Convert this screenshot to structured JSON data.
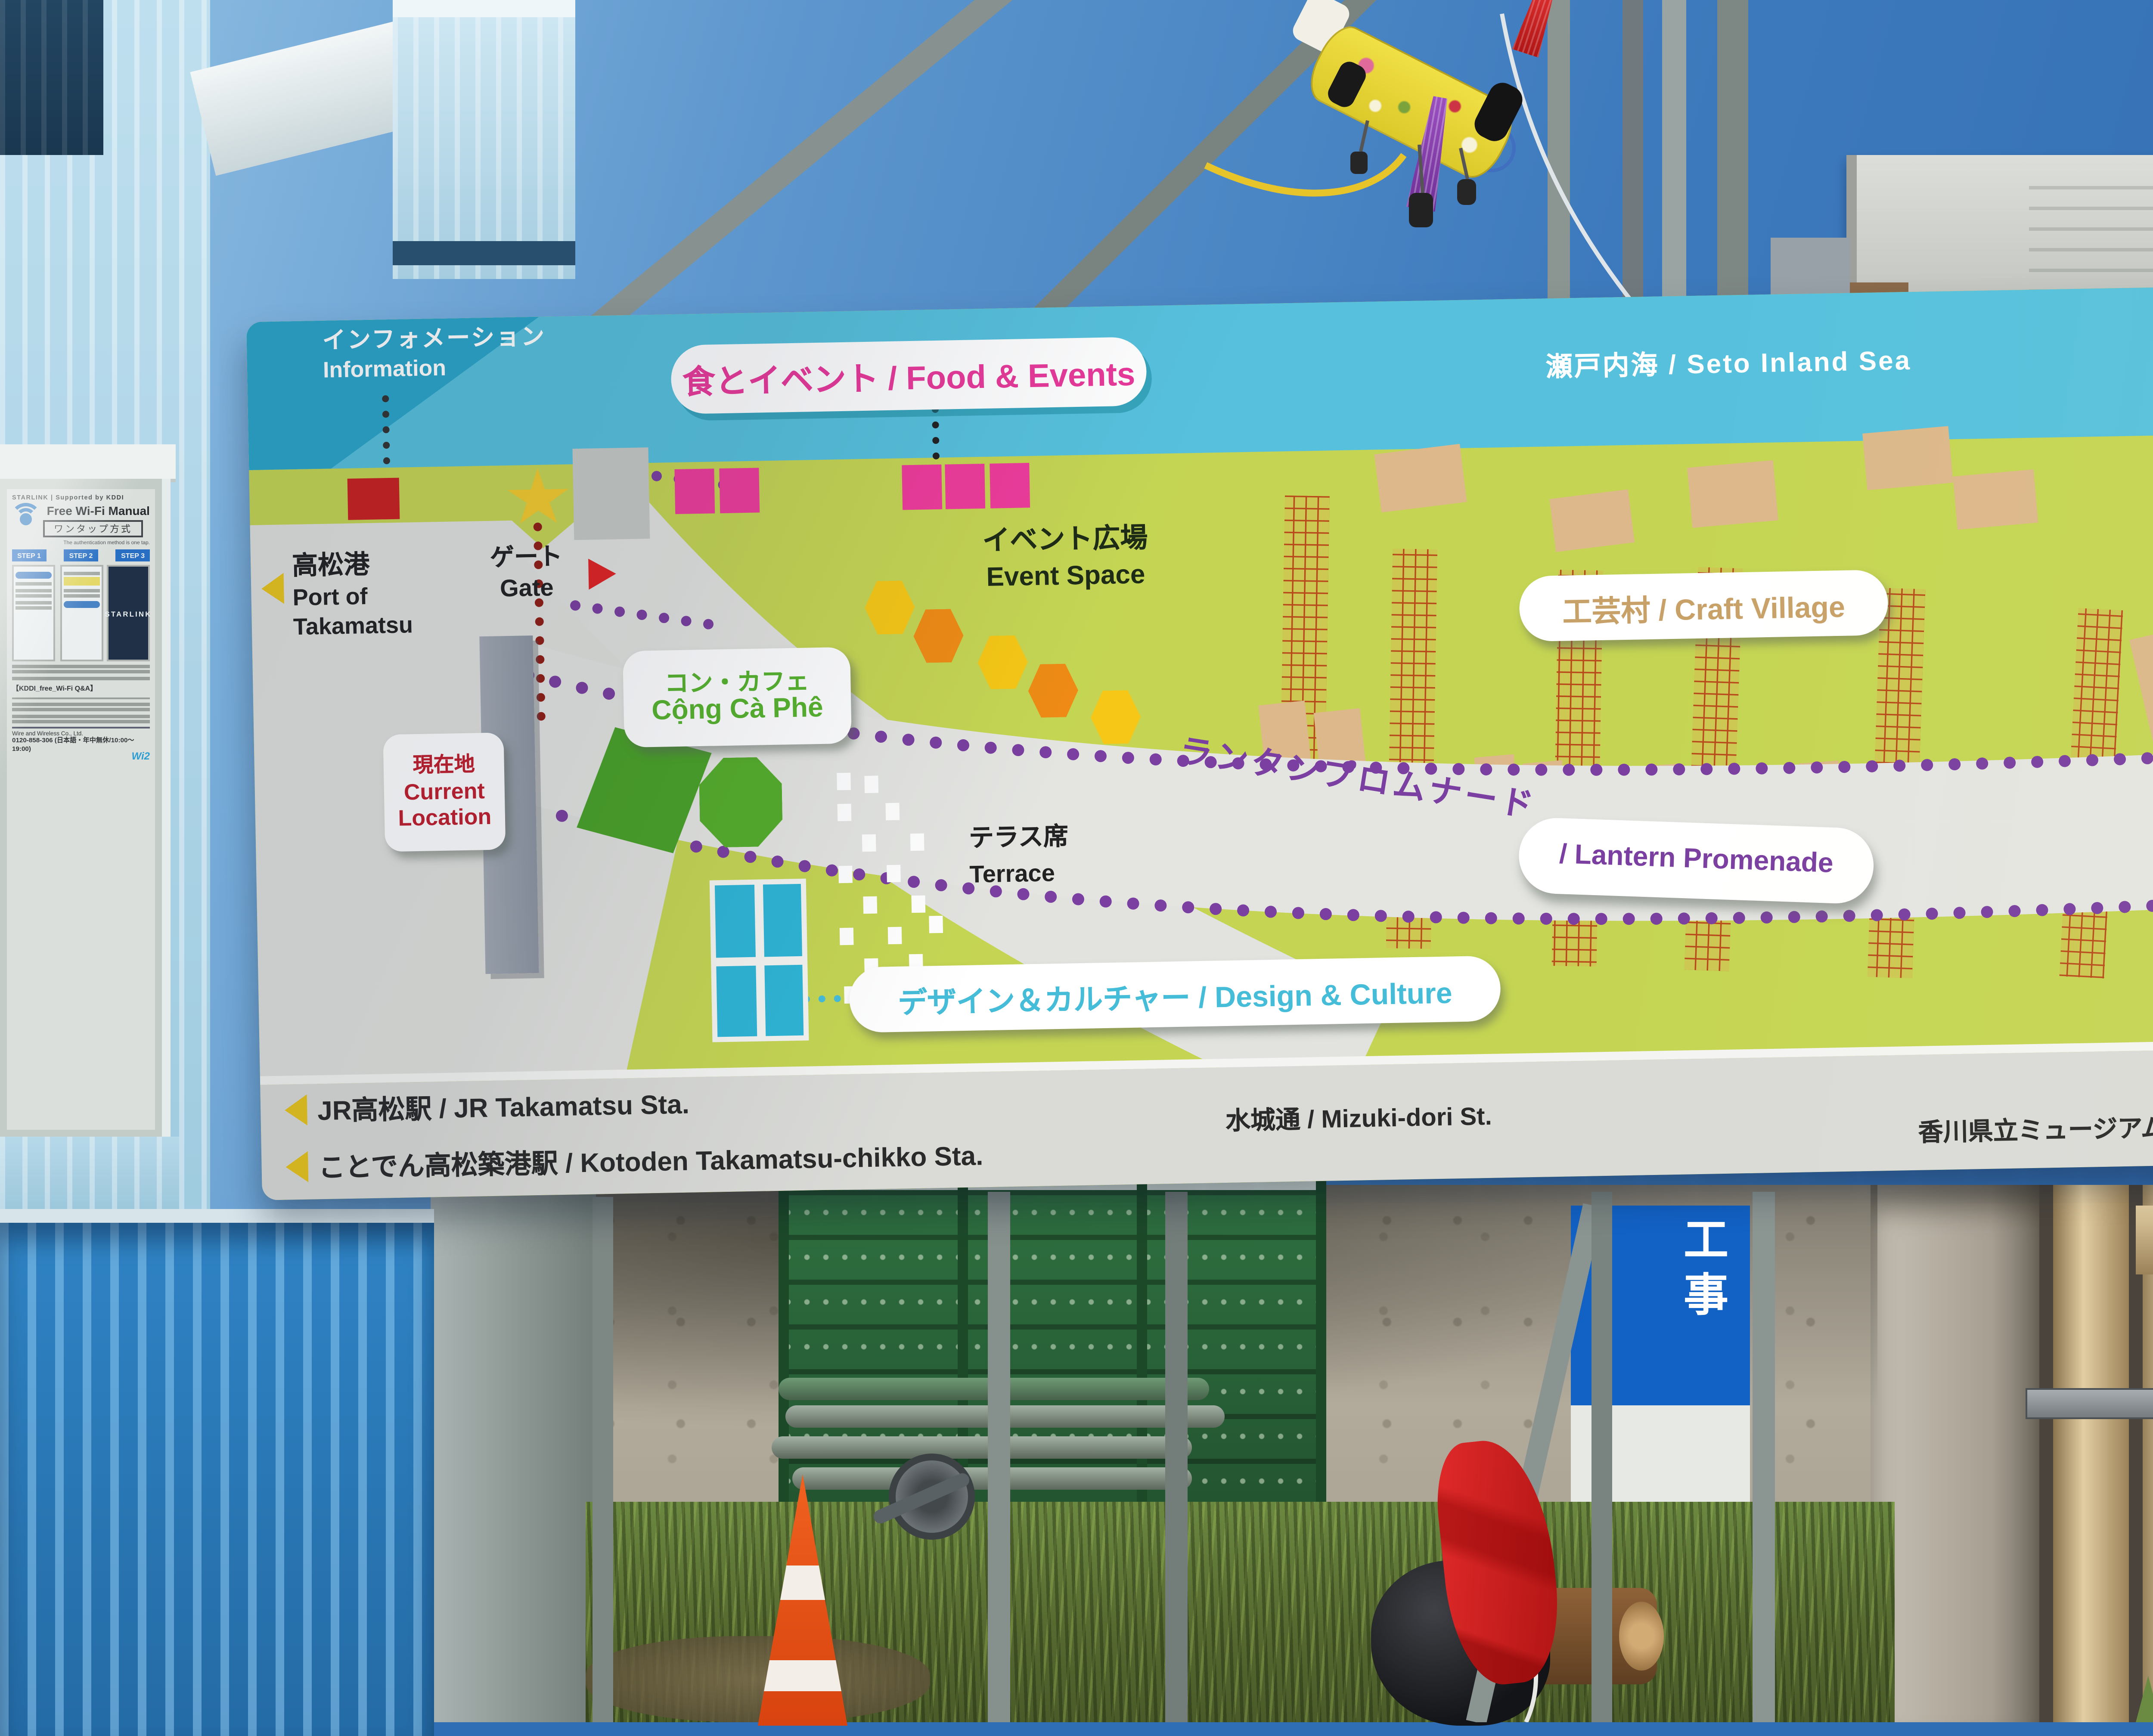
{
  "sign": {
    "north": "N",
    "sea": "瀬戸内海 / Seto Inland Sea",
    "information_jp": "インフォメーション",
    "information_en": "Information",
    "food_events": "食とイベント / Food & Events",
    "event_space_jp": "イベント広場",
    "event_space_en": "Event Space",
    "gate_jp": "ゲート",
    "gate_en": "Gate",
    "port_jp": "高松港",
    "port_en1": "Port of",
    "port_en2": "Takamatsu",
    "current_jp": "現在地",
    "current_en1": "Current",
    "current_en2": "Location",
    "cong_cafe_jp": "コン・カフェ",
    "cong_cafe_en": "Cộng Cà Phê",
    "terrace_jp": "テラス席",
    "terrace_en": "Terrace",
    "craft_village": "工芸村 / Craft Village",
    "bell_jp": "報時鐘",
    "bell_en": "Bell Tower",
    "promenade_jp": "ランタンプロムナード",
    "promenade_en": "/ Lantern Promenade",
    "design_culture": "デザイン＆カルチャー / Design & Culture",
    "brand": "Cộng Moments",
    "brand_sub": "Vietnamese Market",
    "footer_jr": "JR高松駅 / JR Takamatsu Sta.",
    "footer_kotoden": "ことでん高松築港駅 / Kotoden Takamatsu-chikko Sta.",
    "footer_mizuki": "水城通 / Mizuki-dori St.",
    "footer_kagawa": "香川県立ミュージアム / The Kagawa Museum",
    "colors": {
      "sea": "#57c1dd",
      "land": "#c5d553",
      "path_gray": "#e4e5e1",
      "food_pink": "#ee3c9b",
      "promenade_purple": "#7a3fa0",
      "craft_tan": "#c8a168",
      "design_cyan": "#45bcd8",
      "cafe_green": "#57b32e",
      "current_red": "#bf1f2e"
    }
  },
  "poster": {
    "header": "STARLINK | Supported by KDDI",
    "service": "- Free Wi-Fi Service -",
    "title": "Free Wi-Fi Manual",
    "subtitle": "ワンタップ方式",
    "note": "The authentication method is one tap.",
    "steps": {
      "s1": "STEP 1",
      "s2": "STEP 2",
      "s3": "STEP 3"
    },
    "starlink": "STARLINK",
    "qa": "【KDDI_free_Wi-Fi Q&A】",
    "company": "Wire and Wireless Co., Ltd.",
    "phone": "0120-858-306 (日本語・年中無休/10:00〜19:00)",
    "wi2": "Wi2"
  },
  "scene": {
    "construction": "工事"
  }
}
